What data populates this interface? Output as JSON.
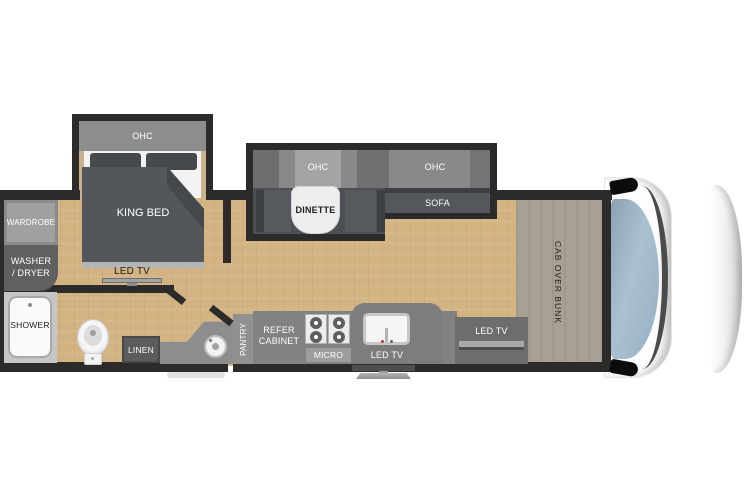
{
  "type": "rv-floorplan",
  "colors": {
    "wall": "#2d2b2a",
    "floor_wood": "#d4b383",
    "slide_dark_gray": "#53565b",
    "cabinet_gray": "#8d8d8d",
    "bunk_tan": "#a8a193",
    "windshield_blue": "#9db4c5",
    "cab_white": "#fdfdfd"
  },
  "bedroom": {
    "ohc_label": "OHC",
    "bed_label": "KING BED",
    "tv_label": "LED TV",
    "wardrobe_label": "WARDROBE",
    "washer_line1": "WASHER",
    "washer_line2": "/ DRYER"
  },
  "bathroom": {
    "shower_label": "SHOWER",
    "linen_label": "LINEN"
  },
  "kitchen": {
    "pantry_label": "PANTRY",
    "refer_label": "REFER CABINET",
    "micro_label": "MICRO",
    "exterior_tv_label": "LED TV"
  },
  "living": {
    "dinette_ohc_label": "OHC",
    "dinette_label": "DINETTE",
    "sofa_ohc_label": "OHC",
    "sofa_label": "SOFA",
    "front_tv_label": "LED TV"
  },
  "cab": {
    "bunk_label": "CAB OVER BUNK"
  }
}
